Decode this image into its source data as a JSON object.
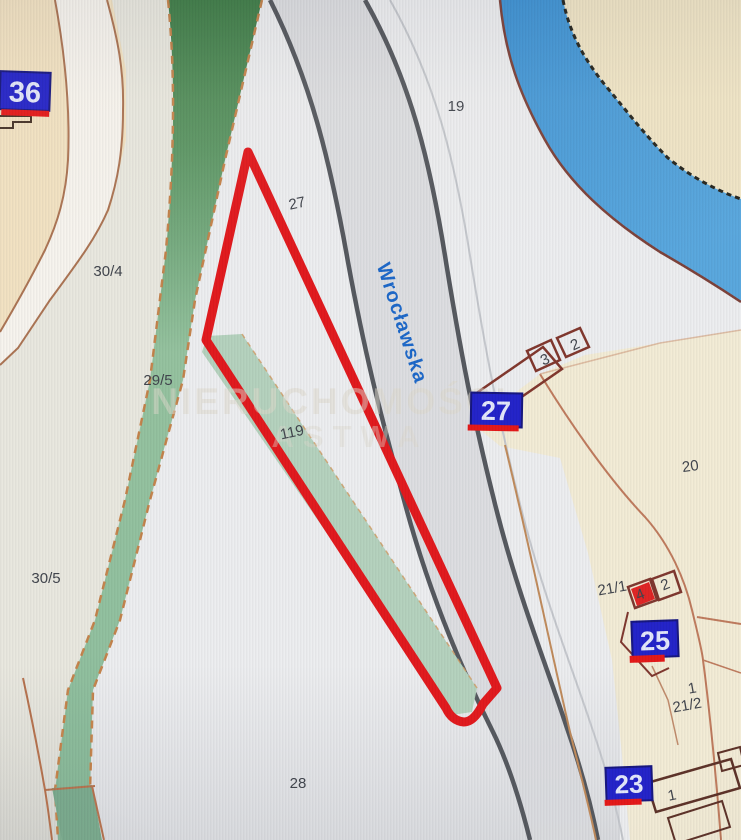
{
  "map": {
    "title": "cadastral-parcel-map",
    "street": {
      "name": "Wrocławska"
    },
    "watermark": {
      "line1": "NIERUCHOMOŚCI",
      "line2": "ASTWA"
    },
    "labels": {
      "l36": "36",
      "l27": "27",
      "l25": "25",
      "l23": "23"
    },
    "parcels": {
      "p19": "19",
      "p27": "27",
      "p30_4": "30/4",
      "p29_5": "29/5",
      "p30_5": "30/5",
      "p119": "119",
      "p20": "20",
      "p21_1": "21/1",
      "p21_2": "21/2",
      "p28": "28"
    },
    "buildings": {
      "b3": "3",
      "b2a": "2",
      "b4": "4",
      "b2b": "2",
      "b1a": "1",
      "b1b": "1"
    },
    "colors": {
      "highlight_outline": "#e2171b",
      "water": "#4598d8",
      "address_label_bg": "#2121c9",
      "address_label_underline": "#e51616",
      "road_line": "#54575d",
      "boundary_salmon": "#bf7a5c",
      "green_strip": "#8fbf9e",
      "street_text": "#1b67c9"
    }
  }
}
